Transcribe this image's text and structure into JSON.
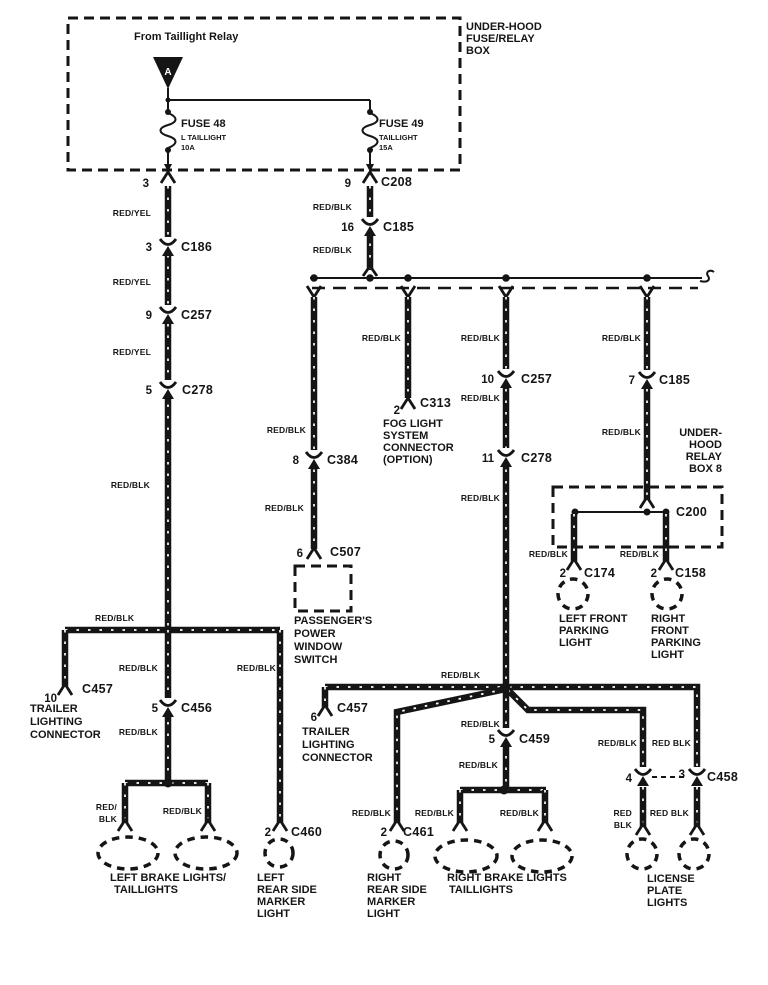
{
  "colors": {
    "ink": "#151515",
    "paper": "#ffffff"
  },
  "header": {
    "box_title": [
      "UNDER-HOOD",
      "FUSE/RELAY",
      "BOX"
    ],
    "source": "From Taillight Relay",
    "source_tag": "A",
    "fuse48": {
      "name": "FUSE 48",
      "desc": "L TAILLIGHT",
      "amp": "10A",
      "pin": "3"
    },
    "fuse49": {
      "name": "FUSE 49",
      "desc": "TAILLIGHT",
      "amp": "15A",
      "pin": "9",
      "conn": "C208"
    }
  },
  "w": {
    "ry": "RED/YEL",
    "rb": "RED/BLK",
    "rbsp": "RED BLK",
    "redsl": "RED/",
    "red": "RED",
    "blk": "BLK"
  },
  "conn": {
    "c186": {
      "pin": "3",
      "id": "C186"
    },
    "c257a": {
      "pin": "9",
      "id": "C257"
    },
    "c278a": {
      "pin": "5",
      "id": "C278"
    },
    "c185a": {
      "pin": "16",
      "id": "C185"
    },
    "c384": {
      "pin": "8",
      "id": "C384"
    },
    "c507": {
      "pin": "6",
      "id": "C507"
    },
    "c313": {
      "pin": "2",
      "id": "C313"
    },
    "c257b": {
      "pin": "10",
      "id": "C257"
    },
    "c278b": {
      "pin": "11",
      "id": "C278"
    },
    "c185b": {
      "pin": "7",
      "id": "C185"
    },
    "c200": {
      "id": "C200"
    },
    "c174": {
      "pin": "2",
      "id": "C174"
    },
    "c158": {
      "pin": "2",
      "id": "C158"
    },
    "c457a": {
      "pin": "10",
      "id": "C457"
    },
    "c456": {
      "pin": "5",
      "id": "C456"
    },
    "c460": {
      "pin": "2",
      "id": "C460"
    },
    "c457b": {
      "pin": "6",
      "id": "C457"
    },
    "c459": {
      "pin": "5",
      "id": "C459"
    },
    "c461": {
      "pin": "2",
      "id": "C461"
    },
    "c458": {
      "pin_a": "4",
      "pin_b": "3",
      "id": "C458"
    }
  },
  "comp": {
    "window_switch": [
      "PASSENGER'S",
      "POWER",
      "WINDOW",
      "SWITCH"
    ],
    "fog": [
      "FOG LIGHT",
      "SYSTEM",
      "CONNECTOR",
      "(OPTION)"
    ],
    "relay_box": [
      "UNDER-",
      "HOOD",
      "RELAY",
      "BOX 8"
    ],
    "lf_park": [
      "LEFT FRONT",
      "PARKING",
      "LIGHT"
    ],
    "rf_park": [
      "RIGHT",
      "FRONT",
      "PARKING",
      "LIGHT"
    ],
    "trailer": [
      "TRAILER",
      "LIGHTING",
      "CONNECTOR"
    ],
    "l_brake": [
      "LEFT BRAKE LIGHTS/",
      "TAILLIGHTS"
    ],
    "l_marker": [
      "LEFT",
      "REAR SIDE",
      "MARKER",
      "LIGHT"
    ],
    "r_marker": [
      "RIGHT",
      "REAR SIDE",
      "MARKER",
      "LIGHT"
    ],
    "r_brake": [
      "RIGHT BRAKE LIGHTS",
      "TAILLIGHTS"
    ],
    "license": [
      "LICENSE",
      "PLATE",
      "LIGHTS"
    ]
  }
}
